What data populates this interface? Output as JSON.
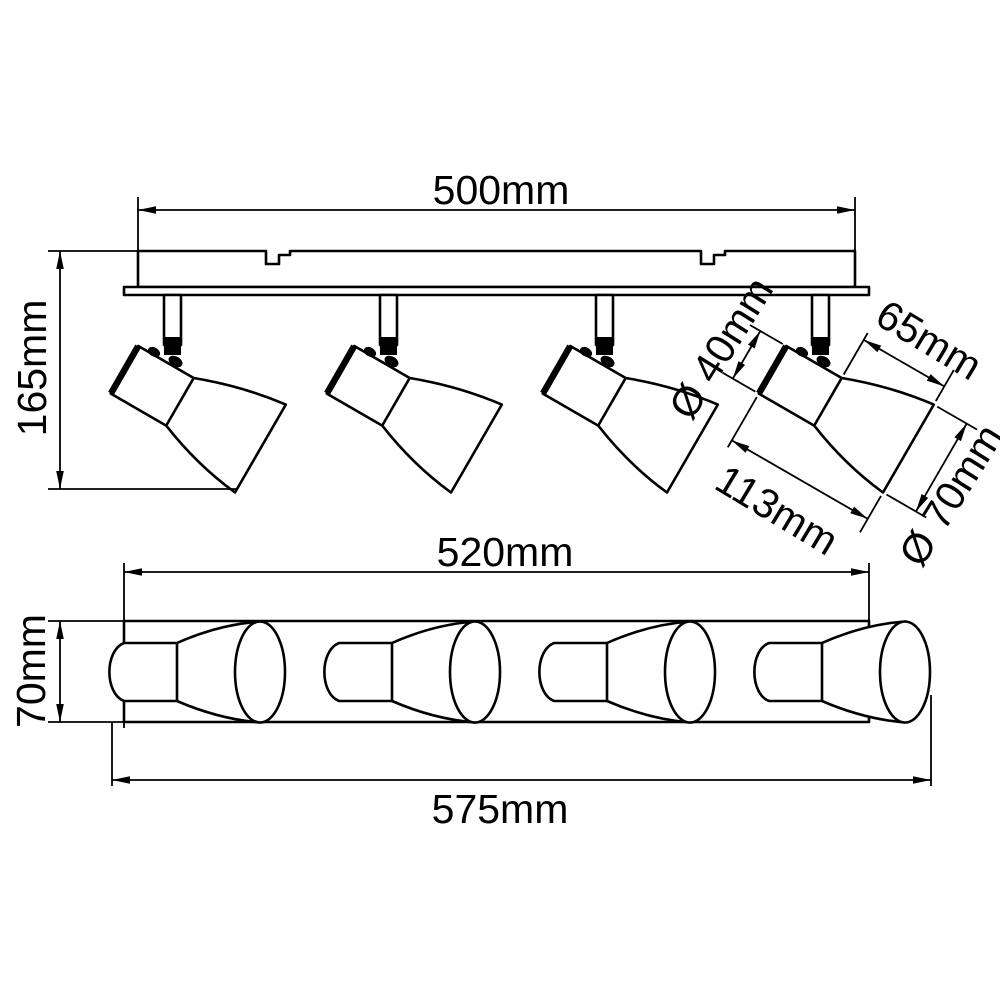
{
  "drawing": {
    "unit": "mm",
    "spotlight_count": 4,
    "colors": {
      "line": "#000000",
      "background": "#ffffff"
    },
    "views": {
      "side": {
        "labels": {
          "bracket_width": "500mm",
          "overall_height": "165mm",
          "head_body_diameter": "Ø 40mm",
          "shade_length": "65mm",
          "head_length": "113mm",
          "shade_diameter": "Ø 70mm"
        }
      },
      "bottom": {
        "labels": {
          "track_length": "520mm",
          "track_depth": "70mm",
          "overall_length": "575mm"
        }
      }
    }
  }
}
